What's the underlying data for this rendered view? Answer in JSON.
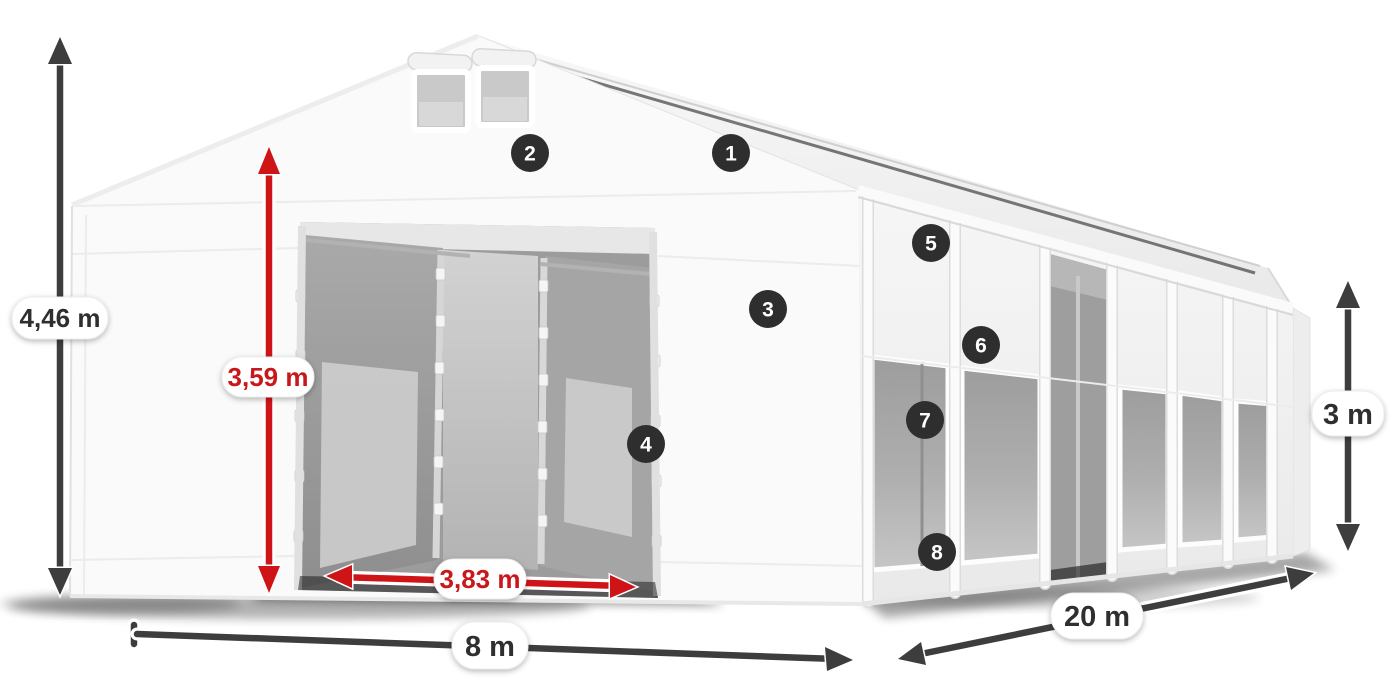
{
  "diagram": {
    "title": "tent-dimension-diagram",
    "subject": "white storage tent with gable front, double doors and windowed side wall",
    "dimensions": {
      "total_height": {
        "value": "4,46 m",
        "style": "dark"
      },
      "door_height": {
        "value": "3,59 m",
        "style": "red"
      },
      "door_width": {
        "value": "3,83 m",
        "style": "red"
      },
      "front_width": {
        "value": "8 m",
        "style": "dark"
      },
      "length": {
        "value": "20 m",
        "style": "dark"
      },
      "side_height": {
        "value": "3 m",
        "style": "dark"
      }
    },
    "callouts": [
      "1",
      "2",
      "3",
      "4",
      "5",
      "6",
      "7",
      "8"
    ],
    "colors": {
      "dimension_dark": "#3d3d3d",
      "dimension_red": "#cf1418",
      "label_text_dark": "#2f2f2f",
      "label_text_red": "#c8181b",
      "badge_background": "#2e2e2e",
      "badge_text": "#ffffff",
      "pill_background": "#ffffff",
      "tent_fabric": "#fafafa"
    }
  }
}
